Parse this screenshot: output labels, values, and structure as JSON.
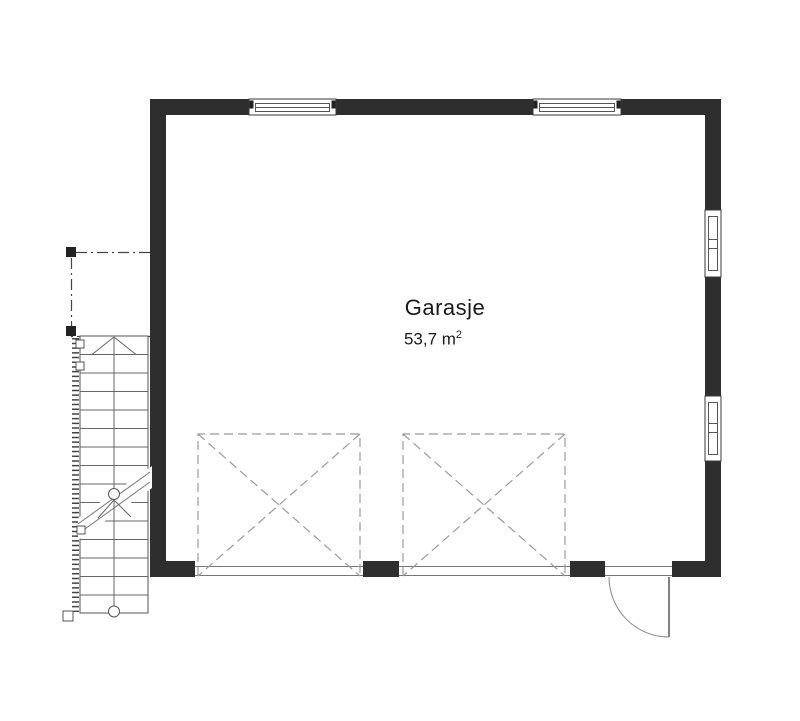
{
  "plan": {
    "room_label": {
      "name": "Garasje",
      "area_value": "53,7 m",
      "area_exponent": "2"
    },
    "colors": {
      "wall": "#2e2e2e",
      "thin_line": "#555555",
      "mid_line": "#6e6e6e",
      "dashed_line": "#9b9b9b",
      "dashdot_line": "#444444",
      "text": "#1a1a1a",
      "background": "#ffffff"
    },
    "symbols": {
      "windows_top": [
        "window-top-left",
        "window-top-right"
      ],
      "windows_right": [
        "window-right-upper",
        "window-right-lower"
      ],
      "garage_door_zones": [
        "garage-door-zone-1",
        "garage-door-zone-2"
      ],
      "entry_door": "entry-door-swing",
      "staircase": "exterior-staircase",
      "overhang": "roof-overhang-outline"
    }
  }
}
